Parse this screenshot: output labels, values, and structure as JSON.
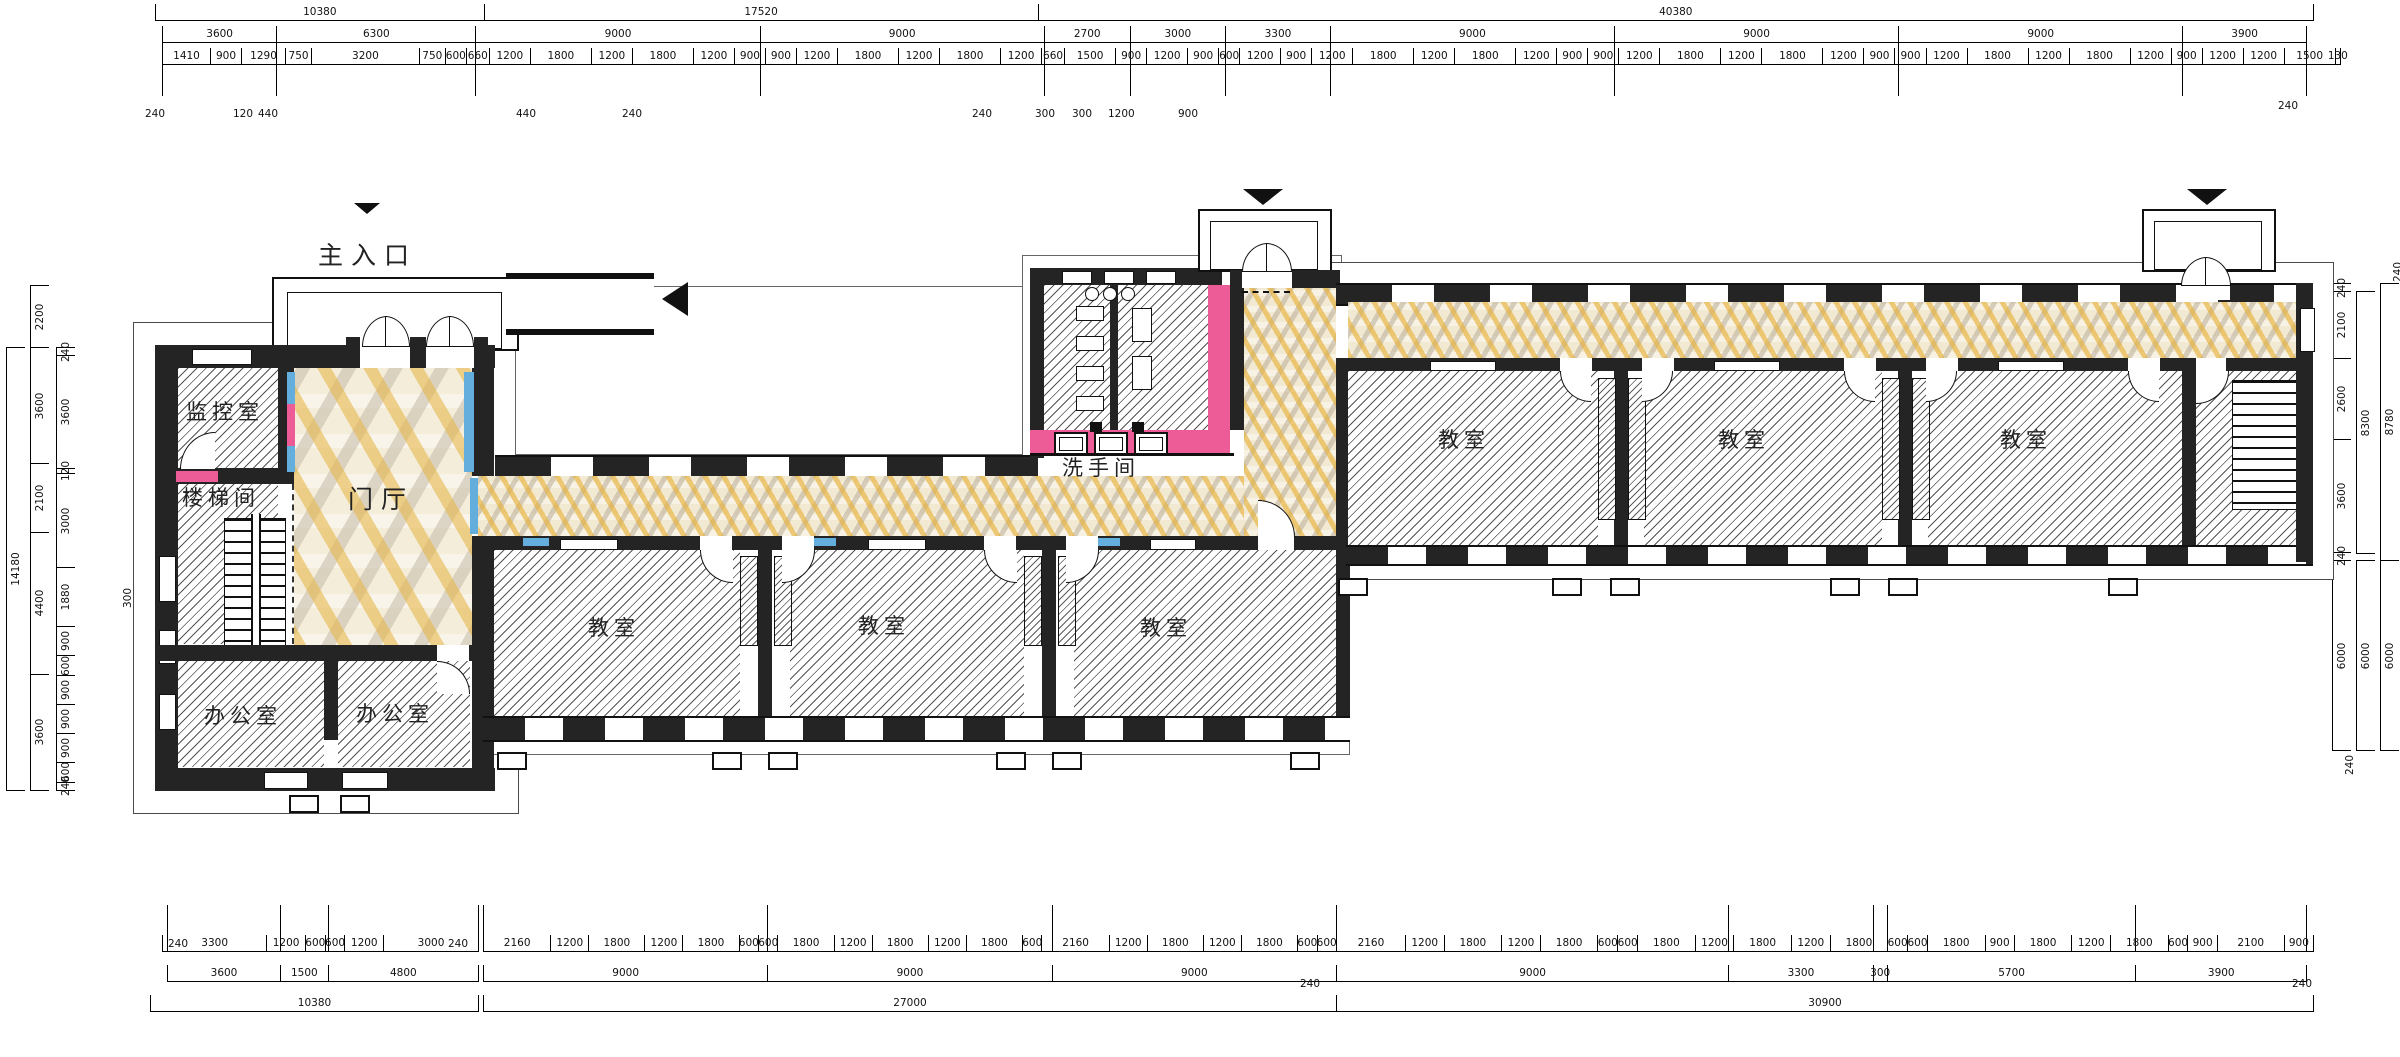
{
  "title": {
    "main_entrance": "主入口"
  },
  "rooms": {
    "monitor_room": "监控室",
    "stairwell": "楼梯间",
    "lobby": "门厅",
    "office_left": "办公室",
    "office_right": "办公室",
    "washroom": "洗手间",
    "classrooms": [
      "教室",
      "教室",
      "教室",
      "教室",
      "教室",
      "教室"
    ]
  },
  "colors": {
    "wall": "#242424",
    "accent_pink": "#ee5c97",
    "accent_blue": "#64aede",
    "mosaic_cream": "#f4edda",
    "mosaic_amber": "#e8b84e",
    "mosaic_gray": "#c6bdab"
  },
  "dims": {
    "top": {
      "tier1": [
        "10380",
        "17520",
        "40380"
      ],
      "tier2": [
        "3600",
        "6300",
        "9000",
        "9000",
        "2700",
        "3000",
        "3300",
        "9000",
        "9000",
        "9000",
        "3900"
      ],
      "tier3": [
        "1410",
        "900",
        "1290",
        "750",
        "3200",
        "750",
        "600",
        "660",
        "1200",
        "1800",
        "1200",
        "1800",
        "1200",
        "900",
        "900",
        "1200",
        "1800",
        "1200",
        "1800",
        "1200",
        "660",
        "1500",
        "900",
        "1200",
        "900",
        "600",
        "1200",
        "900",
        "1200",
        "1800",
        "1200",
        "1800",
        "1200",
        "900",
        "900",
        "1200",
        "1800",
        "1200",
        "1800",
        "1200",
        "900",
        "900",
        "1200",
        "1800",
        "1200",
        "1800",
        "1200",
        "900",
        "1200",
        "1200",
        "1500",
        "130"
      ],
      "offsets": [
        "240",
        "120",
        "440",
        "440",
        "240",
        "240",
        "300",
        "300",
        "1200",
        "900",
        "240"
      ]
    },
    "bottom": {
      "left_tier1": [
        "3300",
        "1200",
        "600",
        "600",
        "1200",
        "3000"
      ],
      "left_tier2": [
        "3600",
        "1500",
        "4800"
      ],
      "left_total": [
        "10380"
      ],
      "mid_tier1": [
        "2160",
        "1200",
        "1800",
        "1200",
        "1800",
        "600",
        "600",
        "1800",
        "1200",
        "1800",
        "1200",
        "1800",
        "600",
        "2160",
        "1200",
        "1800",
        "1200",
        "1800",
        "600",
        "600"
      ],
      "mid_tier2": [
        "9000",
        "9000",
        "9000"
      ],
      "mid_total": [
        "27000"
      ],
      "right_tier1": [
        "2160",
        "1200",
        "1800",
        "1200",
        "1800",
        "600",
        "600",
        "1800",
        "1200",
        "1800",
        "1200",
        "1800",
        "600",
        "600",
        "1800",
        "900",
        "1800",
        "1200",
        "1800",
        "600",
        "900",
        "2100",
        "900"
      ],
      "right_tier2": [
        "9000",
        "3300",
        "300",
        "5700",
        "3900"
      ],
      "right_total": [
        "30900"
      ],
      "offsets": [
        "240",
        "240",
        "240",
        "240"
      ]
    },
    "left": {
      "total": [
        "14180"
      ],
      "canopy": [
        "2200"
      ],
      "axes": [
        "3600",
        "2100",
        "4400",
        "3600"
      ],
      "detail": [
        "240",
        "3600",
        "120",
        "3000",
        "1880",
        "900",
        "600",
        "900",
        "900",
        "900",
        "600",
        "240"
      ],
      "floor_offset": "300"
    },
    "right": {
      "detail": [
        "240",
        "2100",
        "2600",
        "3600",
        "240"
      ],
      "lower_detail": [
        "6000"
      ],
      "mid": [
        "8300"
      ],
      "mid_lower": [
        "6000"
      ],
      "outer": [
        "8780"
      ],
      "outer_lower": [
        "6000"
      ],
      "offsets": [
        "240",
        "240"
      ]
    }
  }
}
